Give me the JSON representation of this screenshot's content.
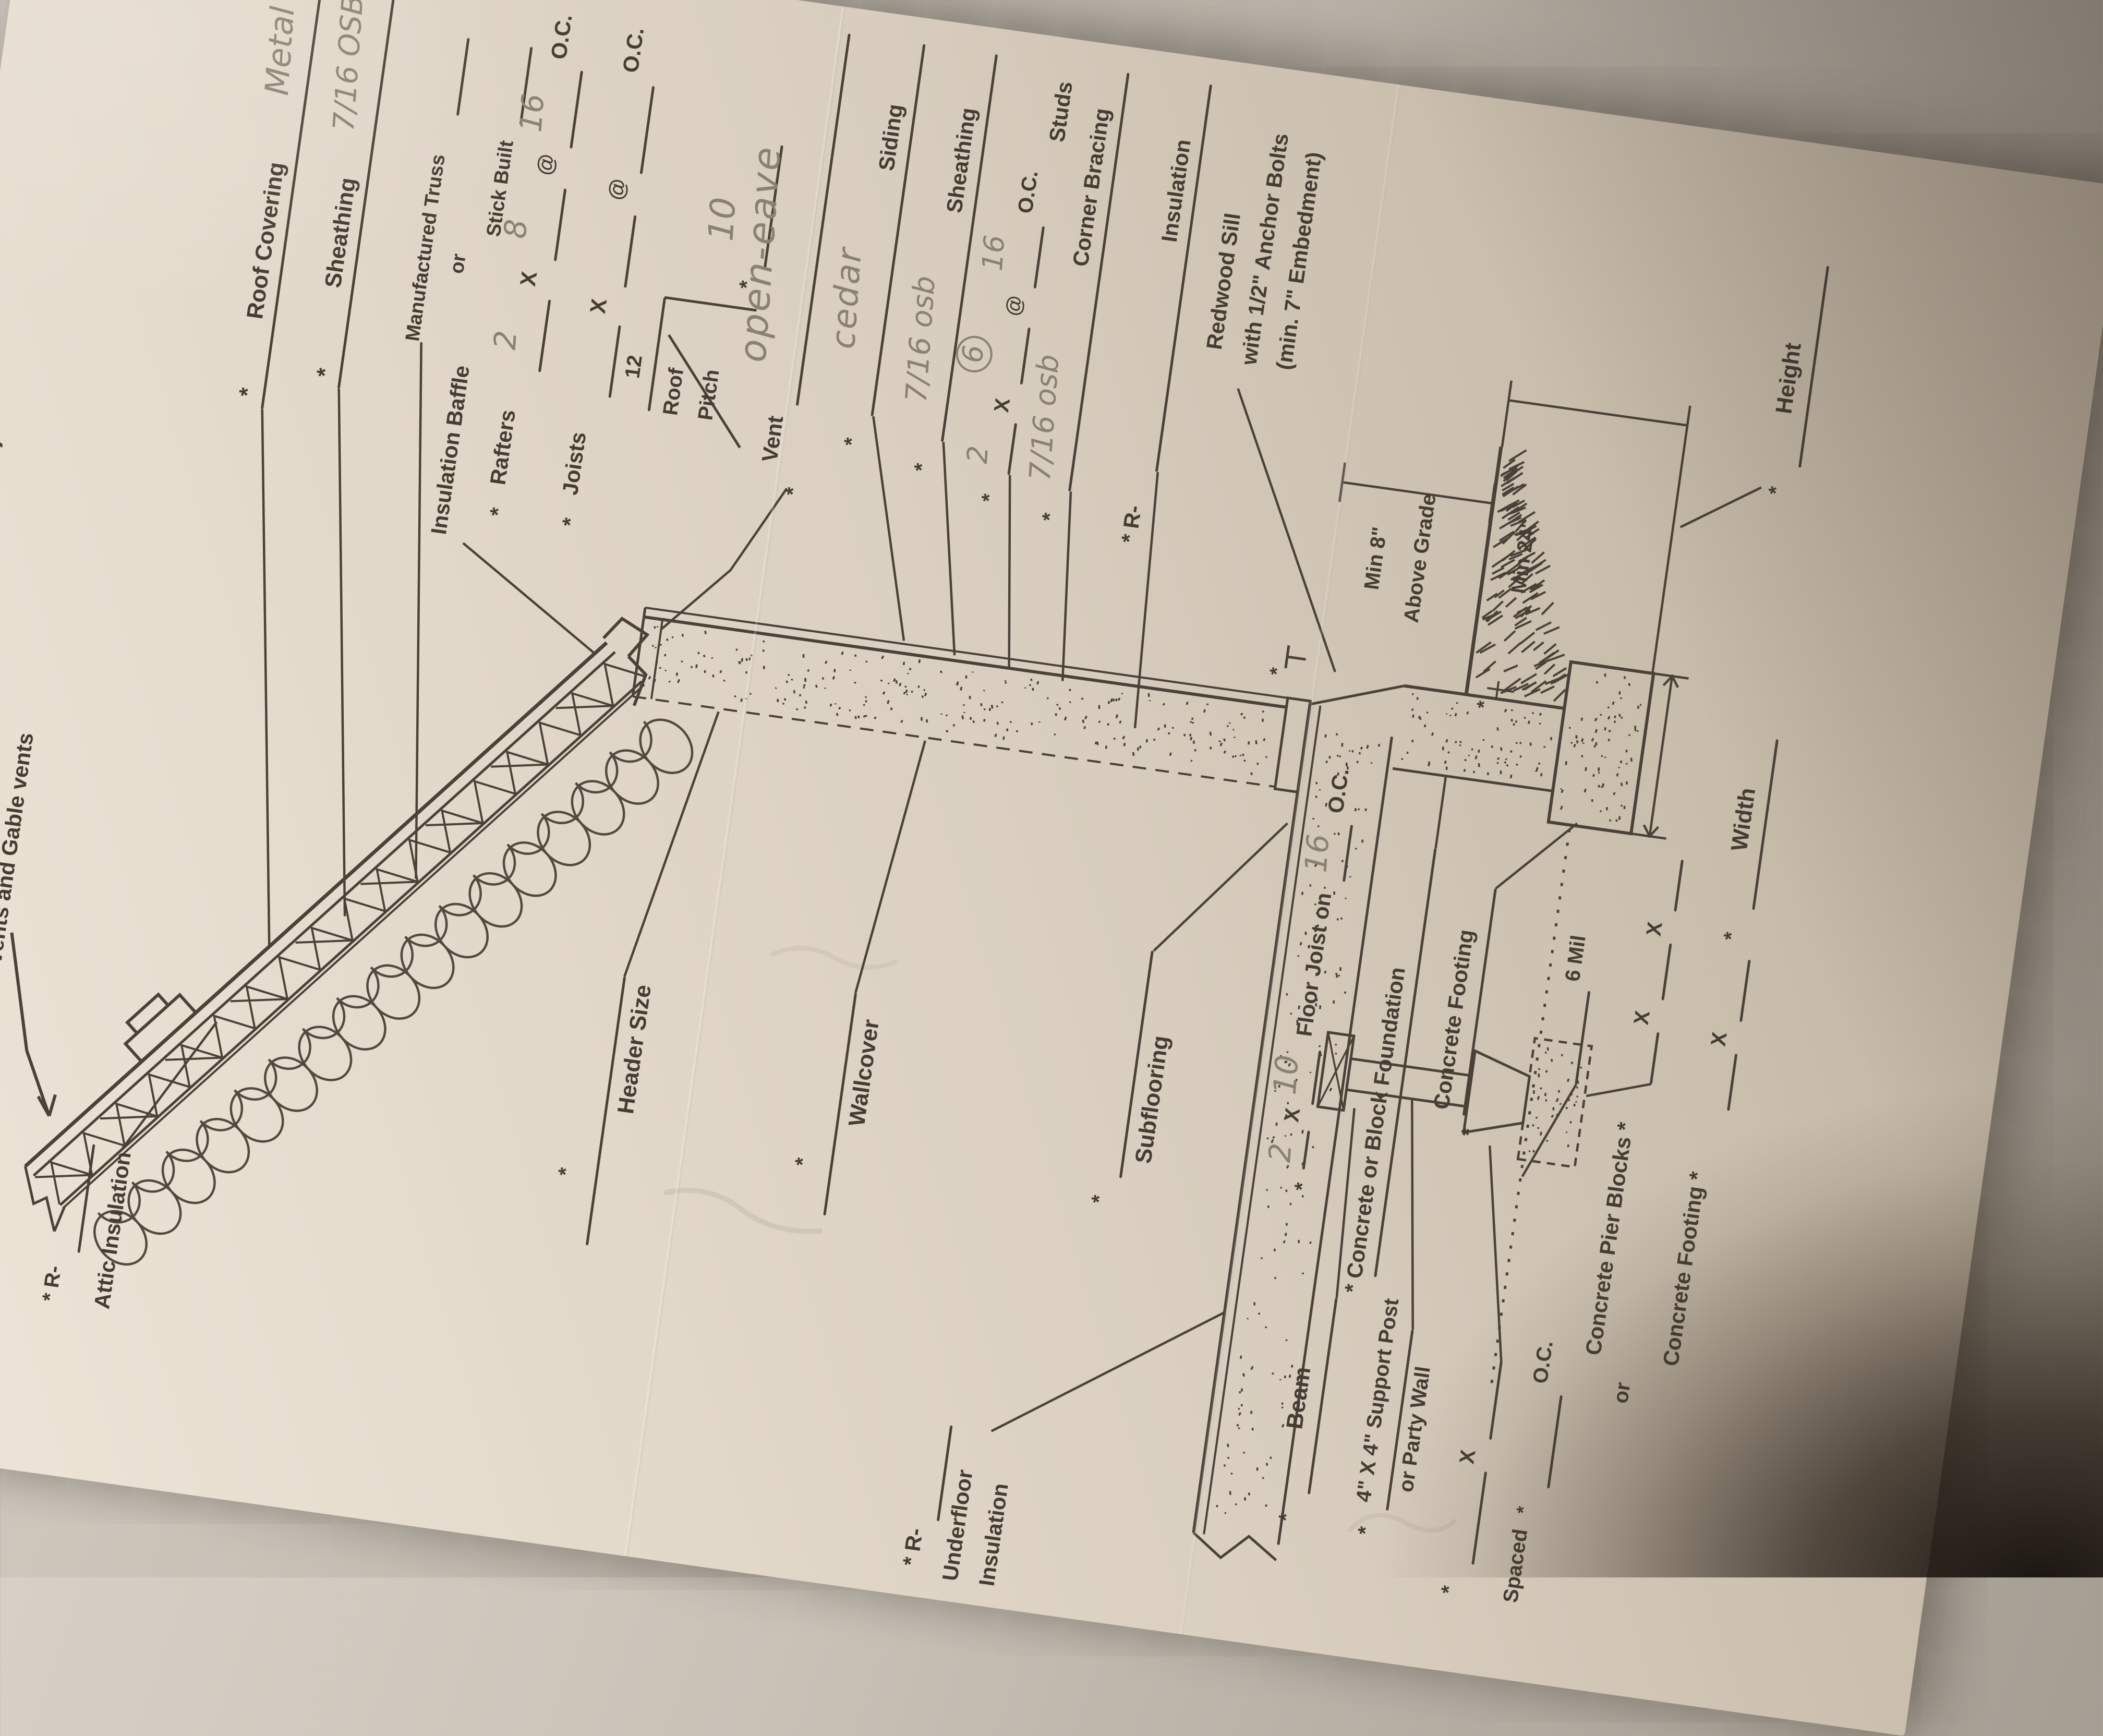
{
  "title": "* (Fill in the Areas Denoted with Asterisk)",
  "marks": {
    "asterisk": "*",
    "r_dash": "R-",
    "x": "X",
    "at": "@",
    "oc": "O.C."
  },
  "roof": {
    "vents_note": "Roof vents and Gable vents",
    "covering": {
      "label": "Roof Covering",
      "value": "Metal"
    },
    "sheathing": {
      "label": "Sheathing",
      "value": "7/16 OSB"
    },
    "truss": {
      "option1": "Manufactured Truss",
      "or": "or",
      "option2": "Stick Built"
    },
    "baffle": "Insulation Baffle",
    "rafters": {
      "label": "Rafters",
      "size1": "2",
      "size2": "8",
      "spacing": "16"
    },
    "joists": {
      "label": "Joists"
    },
    "pitch": {
      "rise": "12",
      "word1": "Roof",
      "word2": "Pitch",
      "value": "10"
    },
    "attic_insulation": {
      "label": "Attic Insulation"
    }
  },
  "wall": {
    "vent": {
      "label": "Vent",
      "value": "open-eave"
    },
    "siding": {
      "label": "Siding",
      "value": "cedar"
    },
    "sheathing": {
      "label": "Sheathing",
      "value": "7/16 osb"
    },
    "studs": {
      "label": "Studs",
      "size1": "2",
      "size2": "6",
      "spacing": "16"
    },
    "corner_bracing": {
      "label": "Corner Bracing",
      "value": "7/16 osb"
    },
    "insulation": {
      "label": "Insulation"
    },
    "redwood_sill": {
      "line1": "Redwood Sill",
      "line2": "with 1/2\" Anchor Bolts",
      "line3": "(min. 7\" Embedment)"
    },
    "header_size": "Header Size",
    "wallcover": "Wallcover"
  },
  "floor": {
    "subflooring": "Subflooring",
    "joist": {
      "size1": "2",
      "label": "Floor Joist on",
      "size2": "10",
      "spacing": "16"
    },
    "underfloor": {
      "line1": "Underfloor",
      "line2": "Insulation"
    },
    "beam": "Beam",
    "post": {
      "line1": "4\" X 4\" Support Post",
      "line2": "or  Party Wall"
    },
    "spaced": {
      "label": "Spaced"
    },
    "pier_blocks": "Concrete Pier Blocks",
    "pier_or": "or",
    "pier_footing": "Concrete Footing"
  },
  "foundation": {
    "wall_label": "Concrete or Block Foundation",
    "footing_label": "Concrete Footing",
    "vapor": "6 Mil",
    "min8": "Min 8\"",
    "above_grade": "Above Grade",
    "min24": "Min 24\"",
    "height": "Height",
    "width": "Width"
  }
}
